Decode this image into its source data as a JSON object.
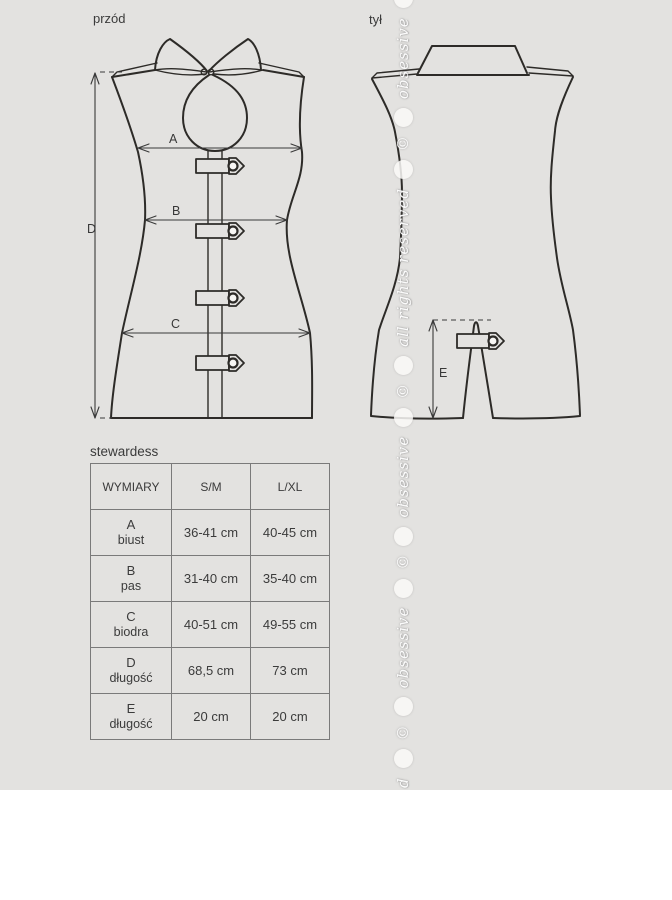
{
  "views": {
    "front_label": "przód",
    "back_label": "tył"
  },
  "product": {
    "name": "stewardess"
  },
  "measures": {
    "A": "A",
    "B": "B",
    "C": "C",
    "D": "D",
    "E": "E"
  },
  "size_table": {
    "col_headers": [
      "WYMIARY",
      "S/M",
      "L/XL"
    ],
    "rows": [
      {
        "letter": "A",
        "label": "biust",
        "sm": "36-41 cm",
        "lxl": "40-45 cm"
      },
      {
        "letter": "B",
        "label": "pas",
        "sm": "31-40 cm",
        "lxl": "35-40 cm"
      },
      {
        "letter": "C",
        "label": "biodra",
        "sm": "40-51 cm",
        "lxl": "49-55 cm"
      },
      {
        "letter": "D",
        "label": "długość",
        "sm": "68,5 cm",
        "lxl": "73 cm"
      },
      {
        "letter": "E",
        "label": "długość",
        "sm": "20 cm",
        "lxl": "20 cm"
      }
    ]
  },
  "watermark": {
    "brand": "obsessive",
    "rights_text": "all rights reserved",
    "copyright_symbol": "©",
    "partial_letter": "d"
  },
  "colors": {
    "background_upper": "#e3e2e0",
    "background_lower": "#ffffff",
    "line": "#2d2b28",
    "text": "#3b3b3b",
    "table_border": "#7a7a7a"
  }
}
